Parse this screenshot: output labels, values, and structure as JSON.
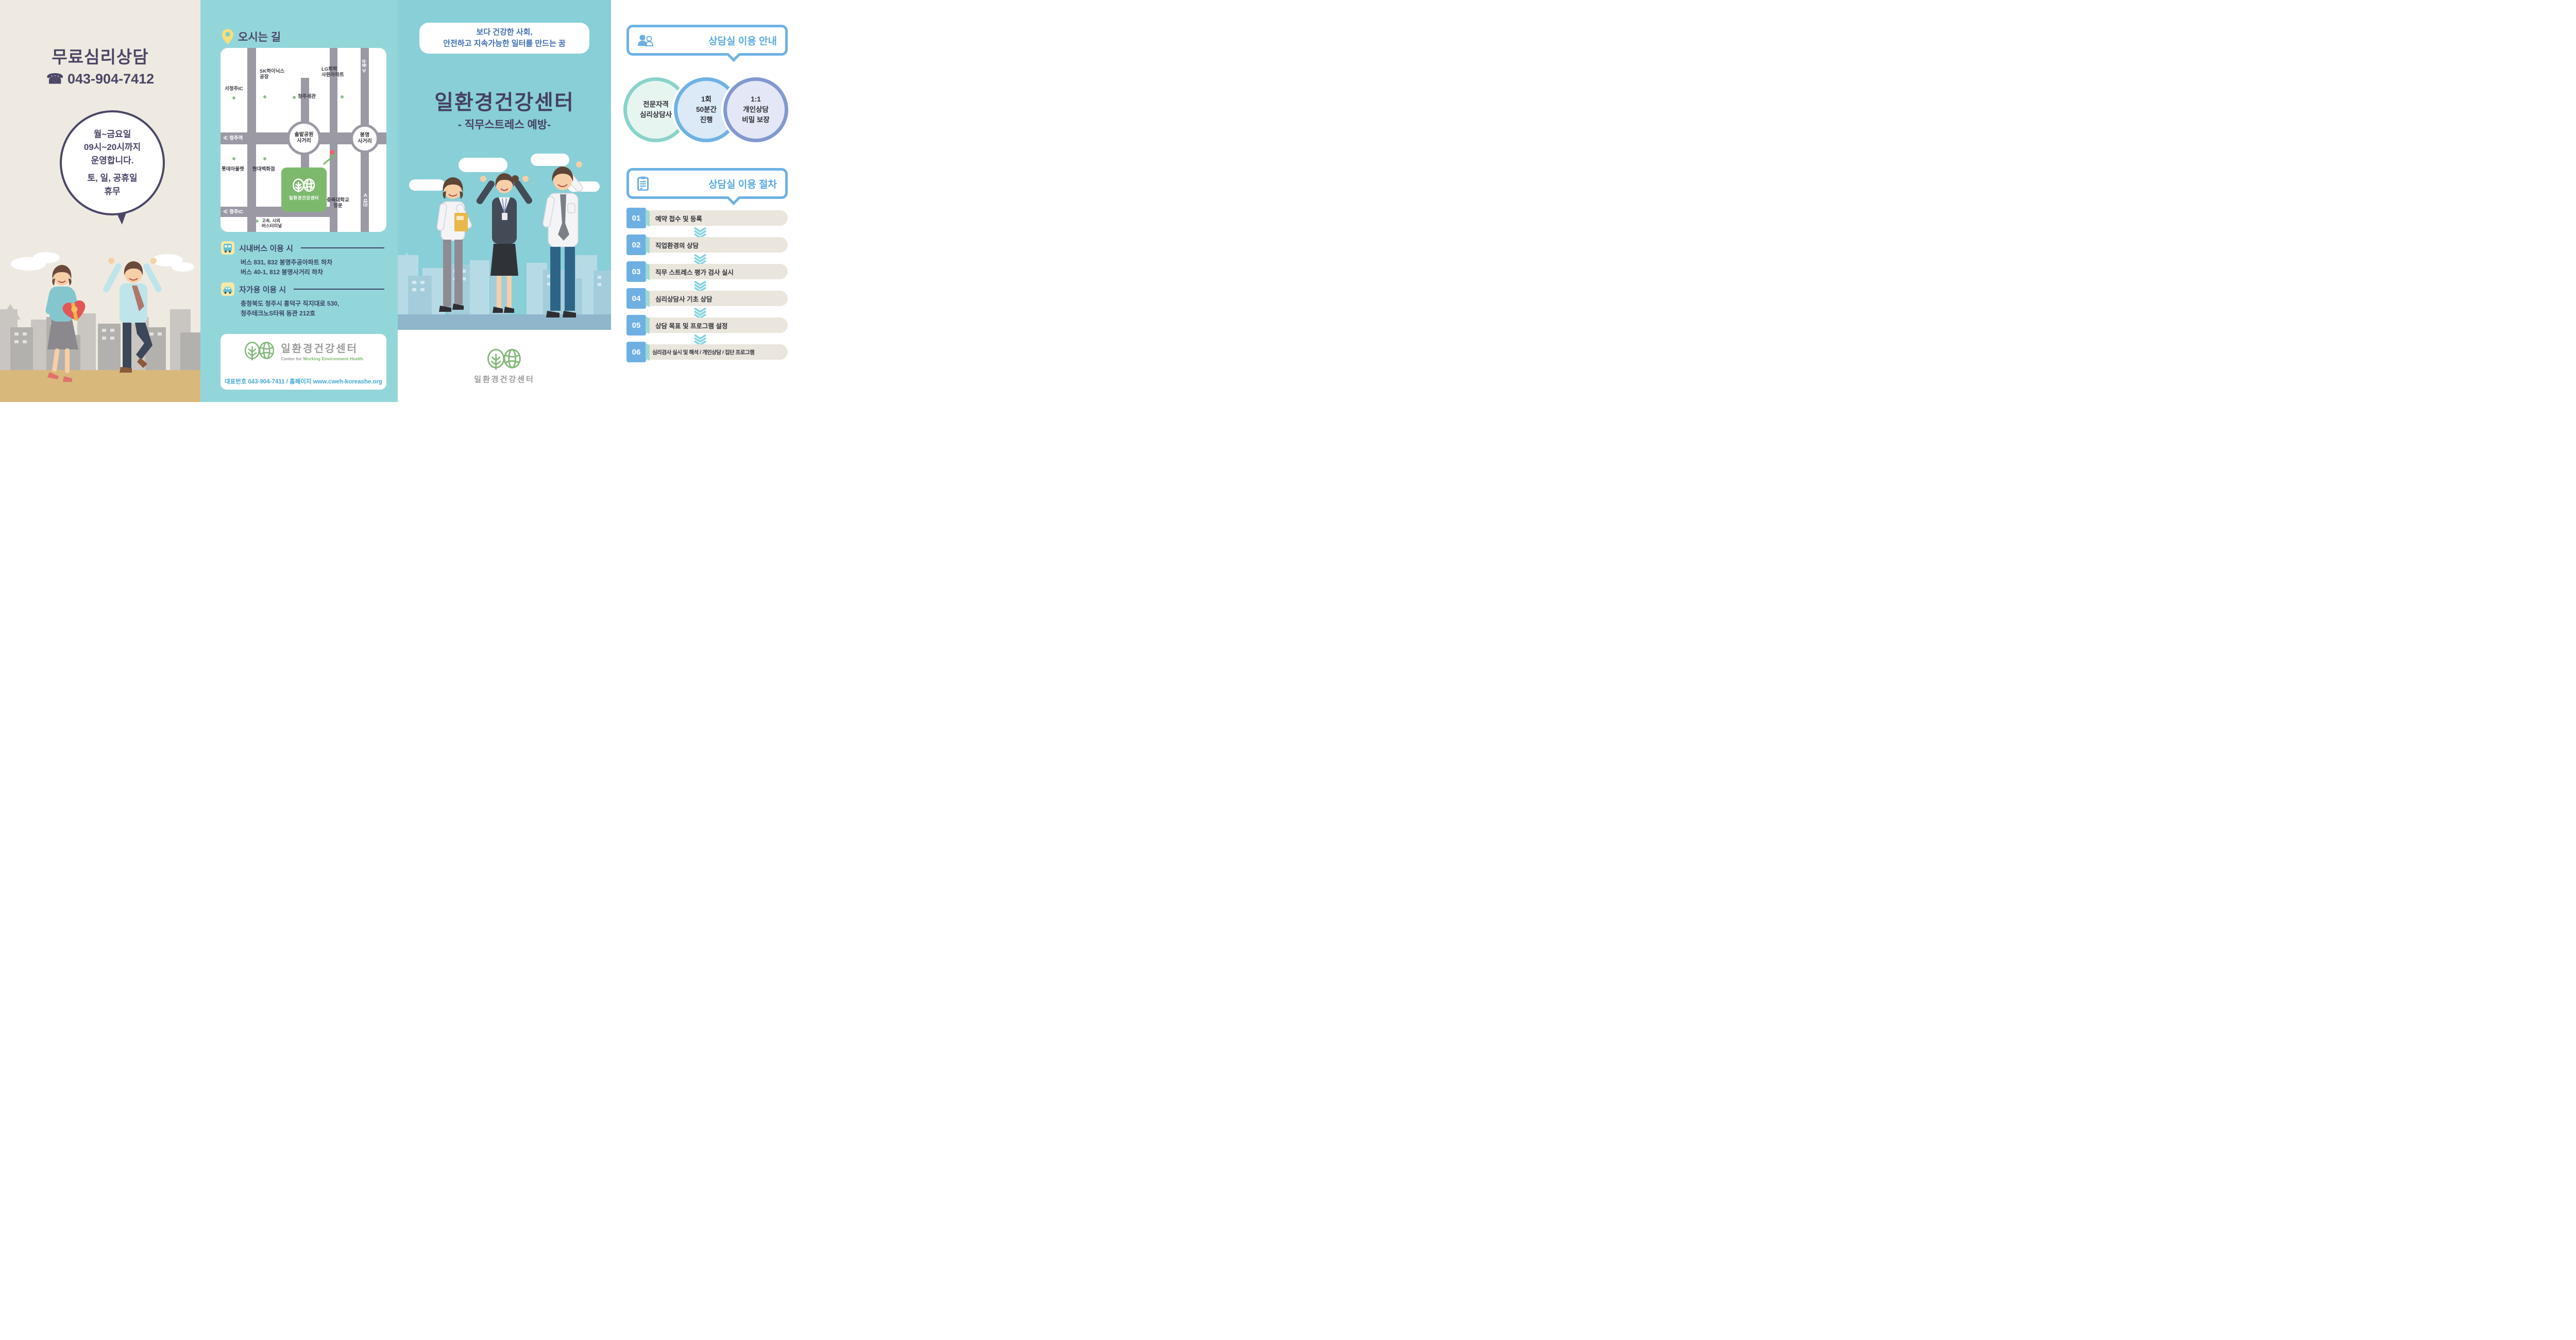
{
  "left_panel": {
    "title": "무료심리상담",
    "phone_icon": "☎",
    "phone": "043-904-7412",
    "hours_bubble": {
      "line1": "월~금요일",
      "line2": "09시~20시까지",
      "line3": "운영합니다.",
      "line4": "토, 일, 공휴일",
      "line5": "휴무"
    }
  },
  "directions_panel": {
    "header_title": "오시는 길",
    "map": {
      "road_left_label": "≪ 청주역",
      "road_bottom_label": "≪ 청주IC",
      "road_top_right_label": "≪ 충주",
      "road_bottom_right_label": "≪ 대전",
      "intersection1": {
        "line1": "솔밭공원",
        "line2": "사거리"
      },
      "intersection2": {
        "line1": "봉명",
        "line2": "사거리"
      },
      "poi": {
        "seocheongju_ic": "서청주IC",
        "sk_line1": "SK하이닉스",
        "sk_line2": "공장",
        "lotte": "롯데아울렛",
        "hyundai": "현대백화점",
        "customs": "청주세관",
        "lg_line1": "LG화학",
        "lg_line2": "사원아파트",
        "univ_line1": "충북대학교",
        "univ_line2": "정문",
        "terminal_line1": "고속. 시외",
        "terminal_line2": "버스터미널"
      },
      "center_label": "일환경건강센터"
    },
    "bus": {
      "title": "시내버스 이용 시",
      "line1": "버스 831, 832 봉명주공아파트 하차",
      "line2": "버스 40-1, 812 봉명사거리 하차"
    },
    "car": {
      "title": "자가용 이용 시",
      "line1": "충청북도 청주시 흥덕구 직지대로 530,",
      "line2": "청주테크노S타워 동관 212호"
    },
    "logo_card": {
      "name_kr": "일환경건강센터",
      "name_en_gray": "Center for ",
      "name_en_green": "Working Environment Health",
      "contact": "대표번호 043-904-7411 / 홈페이지 www.cweh-koreashe.org"
    }
  },
  "cover_panel": {
    "slogan_line1": "보다 건강한 사회,",
    "slogan_line2": "안전하고 지속가능한 일터를 만드는 꿈",
    "title": "일환경건강센터",
    "subtitle": "- 직무스트레스 예방-",
    "footer_logo_text": "일환경건강센터"
  },
  "guide_panel": {
    "section1_title": "상담실 이용 안내",
    "features": [
      {
        "line1": "전문자격",
        "line2": "심리상담사",
        "line3": ""
      },
      {
        "line1": "1회",
        "line2": "50분간",
        "line3": "진행"
      },
      {
        "line1": "1:1",
        "line2": "개인상담",
        "line3": "비밀 보장"
      }
    ],
    "section2_title": "상담실 이용 절차",
    "steps": [
      {
        "num": "01",
        "label": "예약 접수 및 등록"
      },
      {
        "num": "02",
        "label": "직업환경의 상담"
      },
      {
        "num": "03",
        "label": "직무 스트레스 평가 검사 실시"
      },
      {
        "num": "04",
        "label": "심리상담사 기초 상담"
      },
      {
        "num": "05",
        "label": "상담 목표 및 프로그램 설정"
      },
      {
        "num": "06",
        "label": "심리검사 실시 및 해석 / 개인상담 / 집단 프로그램"
      }
    ]
  },
  "colors": {
    "purple_text": "#4b4566",
    "teal_panel": "#88cfd8",
    "blue_accent": "#6db2e5",
    "green_logo": "#7cb96d",
    "contact_blue": "#42a9d5",
    "slogan_blue": "#3e6db3"
  }
}
